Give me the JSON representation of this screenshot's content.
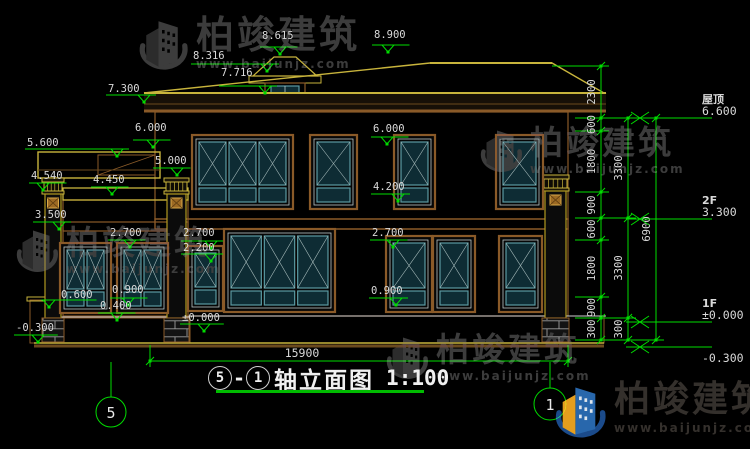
{
  "watermark": {
    "name": "柏竣建筑",
    "url": "www.baijunjz.com"
  },
  "drawing_title": {
    "axis_from": "5",
    "separator": "-",
    "axis_to": "1",
    "name": "轴立面图",
    "scale": "1:100"
  },
  "axis_bubbles": {
    "left": "5",
    "right": "1"
  },
  "dimensions": {
    "total_width": "15900"
  },
  "colors": {
    "dim_line": "#00dd00",
    "cad_yellow": "#c8b43c",
    "cad_brown": "#8a5a28",
    "glass_teal": "#5a9aa2",
    "logo_blue": "#2a6cb5",
    "logo_yellow": "#f2a71f",
    "watermark_gray": "#3f3f3f"
  },
  "drawing": {
    "right_levels": [
      {
        "name": "屋顶",
        "value": "6.600",
        "y": 118
      },
      {
        "name": "2F",
        "value": "3.300",
        "y": 219
      },
      {
        "name": "1F",
        "value": "±0.000",
        "y": 322
      },
      {
        "name": "",
        "value": "-0.300",
        "y": 347
      }
    ],
    "dim_chains": [
      {
        "x": 601,
        "segments": [
          {
            "label": "2300",
            "y1": 66,
            "y2": 118
          },
          {
            "label": "600",
            "y1": 118,
            "y2": 131
          },
          {
            "label": "1800",
            "y1": 131,
            "y2": 192
          },
          {
            "label": "900",
            "y1": 192,
            "y2": 218
          },
          {
            "label": "600",
            "y1": 218,
            "y2": 240
          },
          {
            "label": "1800",
            "y1": 240,
            "y2": 297
          },
          {
            "label": "900",
            "y1": 297,
            "y2": 318
          },
          {
            "label": "300",
            "y1": 318,
            "y2": 340
          }
        ]
      },
      {
        "x": 628,
        "segments": [
          {
            "label": "3300",
            "y1": 118,
            "y2": 218
          },
          {
            "label": "3300",
            "y1": 218,
            "y2": 318
          },
          {
            "label": "300",
            "y1": 318,
            "y2": 340
          }
        ]
      },
      {
        "x": 656,
        "segments": [
          {
            "label": "6900",
            "y1": 118,
            "y2": 340
          }
        ]
      }
    ],
    "elevation_markers": [
      {
        "label": "8.615",
        "lx": 262,
        "ly": 30,
        "ax": 280,
        "ay": 54
      },
      {
        "label": "8.316",
        "lx": 193,
        "ly": 50,
        "ax": 267,
        "ay": 71
      },
      {
        "label": "7.716",
        "lx": 221,
        "ly": 67,
        "ax": 265,
        "ay": 93
      },
      {
        "label": "8.900",
        "lx": 374,
        "ly": 29,
        "ax": 388,
        "ay": 52
      },
      {
        "label": "7.300",
        "lx": 108,
        "ly": 83,
        "ax": 144,
        "ay": 102
      },
      {
        "label": "6.000",
        "lx": 135,
        "ly": 122,
        "ax": 153,
        "ay": 147
      },
      {
        "label": "5.600",
        "lx": 27,
        "ly": 137,
        "ax": 117,
        "ay": 156
      },
      {
        "label": "5.000",
        "lx": 155,
        "ly": 155,
        "ax": 177,
        "ay": 175
      },
      {
        "label": "4.540",
        "lx": 31,
        "ly": 170,
        "ax": 43,
        "ay": 190
      },
      {
        "label": "4.450",
        "lx": 93,
        "ly": 174,
        "ax": 112,
        "ay": 194
      },
      {
        "label": "6.000",
        "lx": 373,
        "ly": 123,
        "ax": 387,
        "ay": 144
      },
      {
        "label": "4.200",
        "lx": 373,
        "ly": 181,
        "ax": 398,
        "ay": 201
      },
      {
        "label": "3.500",
        "lx": 35,
        "ly": 209,
        "ax": 59,
        "ay": 229
      },
      {
        "label": "2.700",
        "lx": 110,
        "ly": 227,
        "ax": 130,
        "ay": 247
      },
      {
        "label": "2.700",
        "lx": 183,
        "ly": 227,
        "ax": 211,
        "ay": 248
      },
      {
        "label": "2.200",
        "lx": 183,
        "ly": 242,
        "ax": 211,
        "ay": 261
      },
      {
        "label": "2.700",
        "lx": 372,
        "ly": 227,
        "ax": 393,
        "ay": 247
      },
      {
        "label": "0.900",
        "lx": 112,
        "ly": 284,
        "ax": 128,
        "ay": 305
      },
      {
        "label": "0.900",
        "lx": 371,
        "ly": 285,
        "ax": 396,
        "ay": 305
      },
      {
        "label": "0.600",
        "lx": 61,
        "ly": 289,
        "ax": 49,
        "ay": 307
      },
      {
        "label": "0.400",
        "lx": 100,
        "ly": 300,
        "ax": 117,
        "ay": 320
      },
      {
        "label": "±0.000",
        "lx": 182,
        "ly": 312,
        "ax": 204,
        "ay": 331
      },
      {
        "label": "-0.300",
        "lx": 16,
        "ly": 322,
        "ax": 38,
        "ay": 342
      }
    ]
  }
}
